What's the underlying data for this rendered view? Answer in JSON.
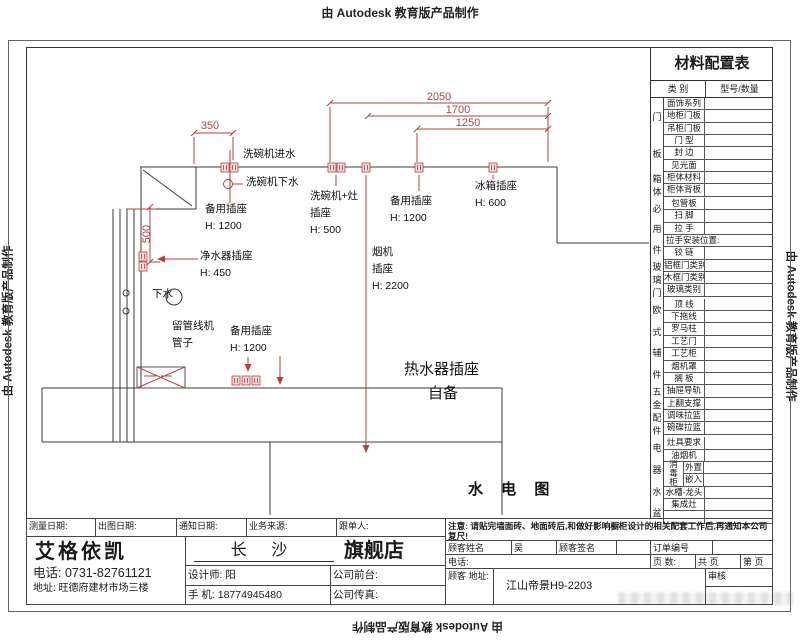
{
  "colors": {
    "accent_red": "#b2433e",
    "line_dark": "#3a3a3a"
  },
  "stamps": {
    "top": "由 Autodesk 教育版产品制作",
    "left": "由 Autodesk 教育版产品制作",
    "right": "由 Autodesk 教育版产品制作",
    "bottom": "由 Autodesk 教育版产品制作"
  },
  "drawing": {
    "title": "水 电 图",
    "dims": {
      "top": "2050",
      "mid": "1700",
      "low": "1250",
      "left": "350",
      "vert": "500"
    },
    "labels": {
      "dishwasher_inlet": "洗碗机进水",
      "dishwasher_drain": "洗碗机下水",
      "spare_socket_top": {
        "l1": "备用插座",
        "l2": "H: 1200"
      },
      "dishwasher_stove_socket": {
        "l1": "洗碗机+灶",
        "l2": "插座",
        "l3": "H: 500"
      },
      "spare_socket_mid": {
        "l1": "备用插座",
        "l2": "H: 1200"
      },
      "fridge_socket": {
        "l1": "冰箱插座",
        "l2": "H: 600"
      },
      "purifier_socket": {
        "l1": "净水器插座",
        "l2": "H: 450"
      },
      "hood_socket": {
        "l1": "烟机",
        "l2": "插座",
        "l3": "H: 2200"
      },
      "drain": "下水",
      "pipe_reserve": {
        "l1": "留管线机",
        "l2": "管子"
      },
      "spare_socket_bottom": {
        "l1": "备用插座",
        "l2": "H: 1200"
      },
      "water_heater": {
        "l1": "热水器插座",
        "l2": "自备"
      }
    }
  },
  "material_table": {
    "title": "材料配置表",
    "col_category": "类 别",
    "col_model": "型号/数量",
    "groups": [
      {
        "name": "门板",
        "rows": [
          {
            "label": "面饰系列"
          },
          {
            "label": "地柜门板"
          },
          {
            "label": "吊柜门板"
          },
          {
            "label": "门 型"
          },
          {
            "label": "封 边"
          },
          {
            "label": "见光面"
          }
        ]
      },
      {
        "name": "箱体",
        "rows": [
          {
            "label": "柜体材料"
          },
          {
            "label": "柜体背板"
          }
        ]
      },
      {
        "name": "必用件",
        "rows": [
          {
            "label": "包管板"
          },
          {
            "label": "扫 脚"
          },
          {
            "label": "拉 手"
          },
          {
            "label": "拉手安装位置:",
            "wide": true
          },
          {
            "label": "铰 链"
          }
        ]
      },
      {
        "name": "玻璃门",
        "rows": [
          {
            "label": "铝框门类别"
          },
          {
            "label": "木框门类别"
          },
          {
            "label": "玻璃类别"
          }
        ]
      },
      {
        "name": "欧式辅件",
        "rows": [
          {
            "label": "顶 线"
          },
          {
            "label": "下拖线"
          },
          {
            "label": "罗马柱"
          },
          {
            "label": "工艺门"
          },
          {
            "label": "工艺柜"
          },
          {
            "label": "烟机罩"
          },
          {
            "label": "搁 板"
          }
        ]
      },
      {
        "name": "五金配件",
        "rows": [
          {
            "label": "抽屉导轨"
          },
          {
            "label": "上翻支撑"
          },
          {
            "label": "调味拉篮"
          },
          {
            "label": "碗碟拉篮"
          }
        ]
      },
      {
        "name": "电器水盆",
        "rows": [
          {
            "label": "灶具要求"
          },
          {
            "label": "油烟机"
          },
          {
            "split": {
              "left": "消毒柜",
              "items": [
                "外置",
                "嵌入"
              ]
            }
          },
          {
            "label": "水槽-龙头"
          },
          {
            "label": "集成灶"
          },
          {
            "label": ""
          }
        ]
      }
    ]
  },
  "title_block": {
    "row1": {
      "measure_date": "测量日期:",
      "plot_date": "出图日期:",
      "notify_date": "通知日期:",
      "biz_source": "业务来源:",
      "follow_up": "跟单人:"
    },
    "company": {
      "name": "艾格依凯",
      "phone": "电话: 0731-82761121",
      "address": "地址: 旺德府建材市场三楼"
    },
    "store": {
      "city": "长 沙",
      "store_type": "旗舰店",
      "designer": "设计师: 阳",
      "front_desk": "公司前台:",
      "mobile": "手 机: 18774945480",
      "fax": "公司传真:"
    },
    "notice": "注意: 请贴完墙面砖、地面砖后,和做好影响橱柜设计的相关配套工作后,再通知本公司复尺!",
    "customer": {
      "name_label": "顾客姓名",
      "name": "吴",
      "sign_label": "顾客签名",
      "order_label": "订单编号",
      "phone_label": "电话:",
      "pages_label": "页 数:",
      "pages_total": "共 页",
      "page_no": "第 页",
      "addr_label": "顾客 地址:",
      "address": "江山帝景H9-2203",
      "audit": "审核"
    }
  }
}
